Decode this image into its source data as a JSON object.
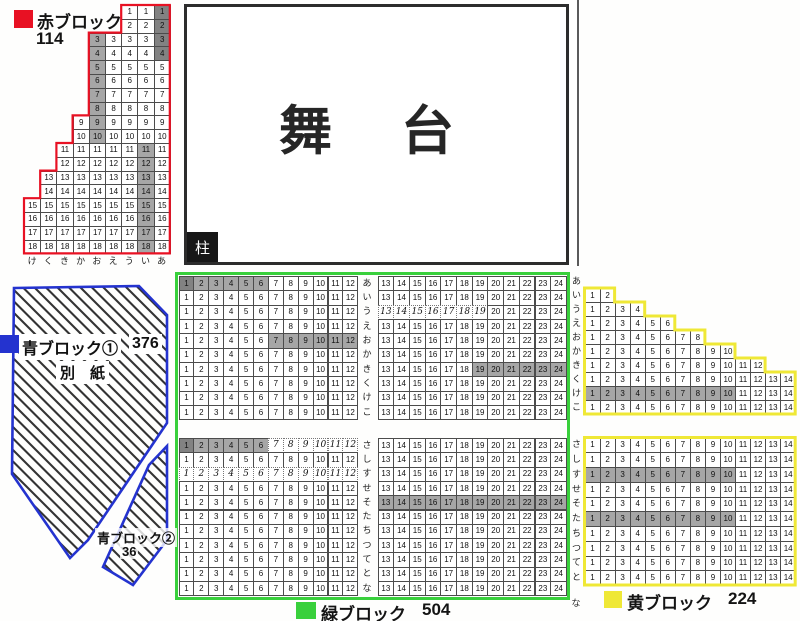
{
  "colors": {
    "red": "#e81123",
    "blue": "#2433cf",
    "green": "#39d03c",
    "yellow": "#efe836",
    "shade_mid": "#a6a6a6",
    "shade_dark": "#828282",
    "hatch": "#333333"
  },
  "stage": {
    "chars": [
      "舞",
      "台"
    ],
    "pillar": "柱"
  },
  "red_block": {
    "legend": {
      "label": "赤ブロック",
      "count": "114"
    },
    "col_letters": [
      "け",
      "く",
      "き",
      "か",
      "お",
      "え",
      "う",
      "い",
      "あ"
    ],
    "rows": [
      {
        "n": "1",
        "start": 7,
        "end": 9,
        "shade": [
          {
            "col": 9,
            "tone": "dark"
          }
        ]
      },
      {
        "n": "2",
        "start": 7,
        "end": 9,
        "shade": [
          {
            "col": 9,
            "tone": "dark"
          }
        ]
      },
      {
        "n": "3",
        "start": 5,
        "end": 9,
        "shade": [
          {
            "col": 5,
            "tone": "mid"
          },
          {
            "col": 9,
            "tone": "dark"
          }
        ]
      },
      {
        "n": "4",
        "start": 5,
        "end": 9,
        "shade": [
          {
            "col": 5,
            "tone": "mid"
          },
          {
            "col": 9,
            "tone": "dark"
          }
        ]
      },
      {
        "n": "5",
        "start": 5,
        "end": 9,
        "shade": [
          {
            "col": 5,
            "tone": "mid"
          }
        ]
      },
      {
        "n": "6",
        "start": 5,
        "end": 9,
        "shade": [
          {
            "col": 5,
            "tone": "mid"
          }
        ]
      },
      {
        "n": "7",
        "start": 5,
        "end": 9,
        "shade": [
          {
            "col": 5,
            "tone": "mid"
          }
        ]
      },
      {
        "n": "8",
        "start": 5,
        "end": 9,
        "shade": [
          {
            "col": 5,
            "tone": "mid"
          }
        ]
      },
      {
        "n": "9",
        "start": 4,
        "end": 9,
        "shade": [
          {
            "col": 5,
            "tone": "mid"
          }
        ]
      },
      {
        "n": "10",
        "start": 4,
        "end": 9,
        "shade": [
          {
            "col": 5,
            "tone": "mid"
          }
        ]
      },
      {
        "n": "11",
        "start": 3,
        "end": 9,
        "shade": [
          {
            "col": 8,
            "tone": "mid"
          }
        ]
      },
      {
        "n": "12",
        "start": 3,
        "end": 9,
        "shade": [
          {
            "col": 8,
            "tone": "mid"
          }
        ]
      },
      {
        "n": "13",
        "start": 2,
        "end": 9,
        "shade": [
          {
            "col": 8,
            "tone": "mid"
          }
        ]
      },
      {
        "n": "14",
        "start": 2,
        "end": 9,
        "shade": [
          {
            "col": 8,
            "tone": "mid"
          }
        ]
      },
      {
        "n": "15",
        "start": 1,
        "end": 9,
        "shade": [
          {
            "col": 8,
            "tone": "mid"
          }
        ]
      },
      {
        "n": "16",
        "start": 1,
        "end": 9,
        "shade": [
          {
            "col": 8,
            "tone": "mid"
          }
        ]
      },
      {
        "n": "17",
        "start": 1,
        "end": 9,
        "shade": [
          {
            "col": 8,
            "tone": "mid"
          }
        ]
      },
      {
        "n": "18",
        "start": 1,
        "end": 9,
        "shade": [
          {
            "col": 8,
            "tone": "mid"
          }
        ]
      }
    ]
  },
  "blue_block": {
    "legend": {
      "label": "青ブロック①",
      "count": "376"
    },
    "note": "別　紙",
    "sub_block": {
      "label": "青ブロック②",
      "count": "36"
    }
  },
  "green_block": {
    "legend": {
      "label": "緑ブロック",
      "count": "504"
    },
    "upper_rows": [
      "あ",
      "い",
      "う",
      "え",
      "お",
      "か",
      "き",
      "く",
      "け",
      "こ"
    ],
    "lower_rows": [
      "さ",
      "し",
      "す",
      "せ",
      "そ",
      "た",
      "ち",
      "つ",
      "て",
      "と",
      "な"
    ],
    "left_seats": {
      "from": 1,
      "to": 12
    },
    "right_seats": {
      "from": 13,
      "to": 24
    },
    "shaded": [
      {
        "section": "upper",
        "row": "あ",
        "from": 1,
        "to": 1,
        "tone": "dark"
      },
      {
        "section": "upper",
        "row": "あ",
        "from": 2,
        "to": 6,
        "tone": "mid"
      },
      {
        "section": "upper",
        "row": "お",
        "from": 7,
        "to": 12,
        "tone": "mid"
      },
      {
        "section": "upper",
        "row": "き",
        "from": 19,
        "to": 24,
        "tone": "mid"
      },
      {
        "section": "lower",
        "row": "さ",
        "from": 1,
        "to": 1,
        "tone": "dark"
      },
      {
        "section": "lower",
        "row": "さ",
        "from": 2,
        "to": 6,
        "tone": "mid"
      },
      {
        "section": "lower",
        "row": "そ",
        "from": 13,
        "to": 24,
        "tone": "mid"
      }
    ],
    "handwritten": [
      {
        "section": "upper",
        "row": "う",
        "from": 13,
        "to": 19
      },
      {
        "section": "lower",
        "row": "さ",
        "from": 7,
        "to": 12
      },
      {
        "section": "lower",
        "row": "す",
        "from": 1,
        "to": 12
      }
    ]
  },
  "yellow_block": {
    "legend": {
      "label": "黄ブロック",
      "count": "224"
    },
    "upper_rows": [
      {
        "label": "あ",
        "seats": 0
      },
      {
        "label": "い",
        "seats": 2
      },
      {
        "label": "う",
        "seats": 4
      },
      {
        "label": "え",
        "seats": 6
      },
      {
        "label": "お",
        "seats": 8
      },
      {
        "label": "か",
        "seats": 10
      },
      {
        "label": "き",
        "seats": 12
      },
      {
        "label": "く",
        "seats": 14
      },
      {
        "label": "け",
        "seats": 14,
        "shaded_to": 10
      },
      {
        "label": "こ",
        "seats": 14
      }
    ],
    "lower_rows": [
      {
        "label": "さ",
        "seats": 14
      },
      {
        "label": "し",
        "seats": 14
      },
      {
        "label": "す",
        "seats": 14,
        "shaded_to": 10
      },
      {
        "label": "せ",
        "seats": 14
      },
      {
        "label": "そ",
        "seats": 14
      },
      {
        "label": "た",
        "seats": 14,
        "shaded_to": 10
      },
      {
        "label": "ち",
        "seats": 14
      },
      {
        "label": "つ",
        "seats": 14
      },
      {
        "label": "て",
        "seats": 14
      },
      {
        "label": "と",
        "seats": 14
      }
    ],
    "trailing_row_label": "な"
  }
}
